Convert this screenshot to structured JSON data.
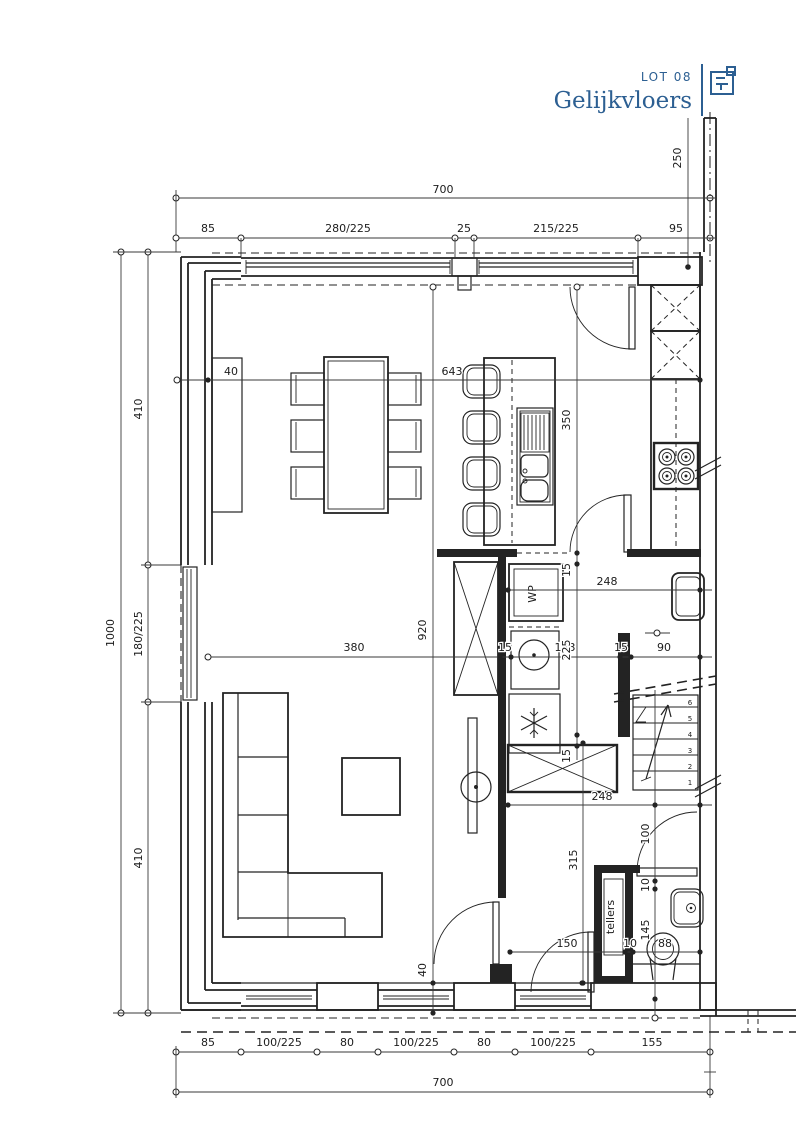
{
  "title_block": {
    "lot_label": "LOT 08",
    "floor_name": "Gelijkvloers"
  },
  "colors": {
    "accent_blue": "#2c5f92",
    "line_color": "#232323",
    "background": "#ffffff"
  },
  "dimensions": {
    "top_overall": "700",
    "top_chain": [
      "85",
      "280/225",
      "25",
      "215/225",
      "95"
    ],
    "right_upper": "250",
    "left_overall": "1000",
    "left_chain": [
      "410",
      "180/225",
      "410"
    ],
    "bottom_chain": [
      "85",
      "100/225",
      "80",
      "100/225",
      "80",
      "100/225",
      "155"
    ],
    "bottom_overall": "700",
    "interior": {
      "wall_top": "40",
      "width_inner": "643",
      "island_len": "350",
      "height_inner": "920",
      "living_width": "380",
      "seg_15_a": "15",
      "seg_143": "143",
      "seg_15_b": "15",
      "seg_90": "90",
      "hall_upper": "248",
      "closet_15": "15",
      "closet_225": "225",
      "band_15": "15",
      "hall_lower": "248",
      "hall_len": "315",
      "wc_100": "100",
      "wc_10_a": "10",
      "wc_145": "145",
      "wc_150": "150",
      "wc_10_b": "10",
      "wc_88": "88",
      "wall_bottom": "40"
    }
  },
  "labels": {
    "heat_pump": "WP",
    "meter_closet": "tellers",
    "stair_steps": [
      "1",
      "2",
      "3",
      "4",
      "5",
      "6"
    ]
  }
}
